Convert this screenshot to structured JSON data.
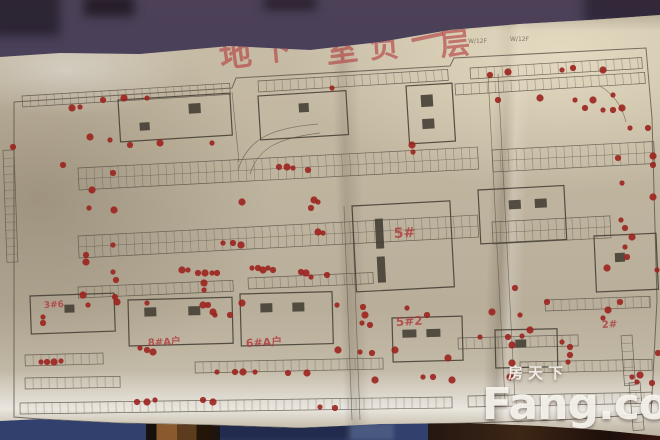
{
  "watermark": {
    "line1": "房天下",
    "line2": "Fang.com"
  },
  "title": {
    "text": "地下室负一层",
    "color": "#b23a3c",
    "chars": [
      {
        "c": "地",
        "x": 237,
        "y": 66,
        "s": 32,
        "r": -8
      },
      {
        "c": "下",
        "x": 277,
        "y": 60,
        "s": 30,
        "r": -5
      },
      {
        "c": "室",
        "x": 343,
        "y": 61,
        "s": 32,
        "r": -7
      },
      {
        "c": "负",
        "x": 385,
        "y": 57,
        "s": 30,
        "r": -4
      },
      {
        "c": "一",
        "x": 430,
        "y": 50,
        "s": 34,
        "r": -12
      },
      {
        "c": "层",
        "x": 456,
        "y": 54,
        "s": 30,
        "r": -6
      }
    ]
  },
  "plan": {
    "colors": {
      "paper": "#c3b8a2",
      "wall_top": "#4c4157",
      "wall_bottom": "#31406d",
      "line": "#5b5448",
      "building": "#474136",
      "core": "#3e382f",
      "dot": "#9c221e",
      "marker": "#b23a3c",
      "pencil": "#7a7263"
    },
    "boundary": "M14,102 L232,88 L236,78 L450,66 L454,58 L646,48 L652,118 L657,300 L651,414 L560,420 L470,423 L380,425 L300,428 L210,425 L118,423 L40,419 L14,417 Z",
    "roads": [
      "M238,170 C248,138 272,128 318,124",
      "M250,174 C258,148 278,138 320,133",
      "M488,74 L505,400",
      "M498,74 L515,400",
      "M344,206 L352,420",
      "M352,206 L360,420",
      "M232,92 L239,162",
      "M600,86 Q620,98 626,122"
    ],
    "strips": [
      {
        "x": 22,
        "y": 96,
        "w": 208,
        "rows": 1,
        "t": -3.5
      },
      {
        "x": 258,
        "y": 81,
        "w": 190,
        "rows": 1,
        "t": -3.5
      },
      {
        "x": 470,
        "y": 68,
        "w": 172,
        "rows": 1,
        "t": -3.5
      },
      {
        "x": 455,
        "y": 84,
        "w": 190,
        "rows": 1,
        "t": -3.5
      },
      {
        "x": 78,
        "y": 168,
        "w": 400,
        "rows": 2,
        "t": -3
      },
      {
        "x": 492,
        "y": 150,
        "w": 162,
        "rows": 2,
        "t": -3
      },
      {
        "x": 78,
        "y": 236,
        "w": 400,
        "rows": 2,
        "t": -3
      },
      {
        "x": 492,
        "y": 222,
        "w": 118,
        "rows": 2,
        "t": -3
      },
      {
        "x": 78,
        "y": 287,
        "w": 155,
        "rows": 1,
        "t": -2.5
      },
      {
        "x": 248,
        "y": 278,
        "w": 125,
        "rows": 1,
        "t": -2.5
      },
      {
        "x": 545,
        "y": 300,
        "w": 105,
        "rows": 1,
        "t": -2
      },
      {
        "x": 25,
        "y": 355,
        "w": 78,
        "rows": 1,
        "t": -1.5
      },
      {
        "x": 25,
        "y": 378,
        "w": 95,
        "rows": 1,
        "t": -1
      },
      {
        "x": 195,
        "y": 362,
        "w": 188,
        "rows": 1,
        "t": -1.2
      },
      {
        "x": 458,
        "y": 338,
        "w": 120,
        "rows": 1,
        "t": -1.5
      },
      {
        "x": 520,
        "y": 362,
        "w": 132,
        "rows": 1,
        "t": -1.2
      },
      {
        "x": 20,
        "y": 403,
        "w": 432,
        "rows": 1,
        "t": -0.8
      },
      {
        "x": 468,
        "y": 396,
        "w": 184,
        "rows": 1,
        "t": -1.2
      },
      {
        "x": 14,
        "y": 150,
        "w": 112,
        "rows": 1,
        "t": 88
      },
      {
        "x": 632,
        "y": 335,
        "w": 50,
        "rows": 1,
        "t": 86
      },
      {
        "x": 640,
        "y": 382,
        "w": 48,
        "rows": 1,
        "t": 85
      }
    ],
    "buildings": [
      {
        "x": 118,
        "y": 100,
        "w": 112,
        "h": 42,
        "t": -3.5,
        "cores": [
          [
            70,
            8,
            12,
            10
          ],
          [
            20,
            24,
            10,
            8
          ]
        ]
      },
      {
        "x": 258,
        "y": 96,
        "w": 88,
        "h": 44,
        "t": -3.5,
        "cores": [
          [
            40,
            10,
            10,
            9
          ]
        ]
      },
      {
        "x": 406,
        "y": 86,
        "w": 46,
        "h": 58,
        "t": -3.5,
        "cores": [
          [
            14,
            10,
            12,
            12
          ],
          [
            14,
            34,
            12,
            10
          ]
        ]
      },
      {
        "x": 352,
        "y": 206,
        "w": 98,
        "h": 86,
        "t": -3,
        "cores": [
          [
            22,
            14,
            8,
            30
          ],
          [
            22,
            52,
            8,
            26
          ]
        ]
      },
      {
        "x": 478,
        "y": 190,
        "w": 86,
        "h": 54,
        "t": -3,
        "cores": [
          [
            30,
            12,
            12,
            9
          ],
          [
            56,
            12,
            12,
            9
          ]
        ]
      },
      {
        "x": 594,
        "y": 236,
        "w": 62,
        "h": 56,
        "t": -2.5,
        "cores": [
          [
            20,
            18,
            10,
            9
          ]
        ]
      },
      {
        "x": 30,
        "y": 296,
        "w": 84,
        "h": 38,
        "t": -2,
        "cores": [
          [
            34,
            10,
            10,
            8
          ]
        ]
      },
      {
        "x": 128,
        "y": 300,
        "w": 104,
        "h": 46,
        "t": -1.5,
        "cores": [
          [
            16,
            8,
            12,
            9
          ],
          [
            60,
            8,
            12,
            9
          ]
        ]
      },
      {
        "x": 240,
        "y": 294,
        "w": 92,
        "h": 52,
        "t": -1.5,
        "cores": [
          [
            20,
            10,
            12,
            9
          ],
          [
            52,
            10,
            12,
            9
          ]
        ]
      },
      {
        "x": 392,
        "y": 318,
        "w": 70,
        "h": 44,
        "t": -1.5,
        "cores": [
          [
            10,
            12,
            14,
            8
          ],
          [
            34,
            12,
            14,
            8
          ]
        ]
      },
      {
        "x": 495,
        "y": 330,
        "w": 62,
        "h": 38,
        "t": -1.2,
        "cores": [
          [
            20,
            10,
            11,
            8
          ]
        ]
      }
    ],
    "annotations": [
      {
        "text": "5#",
        "x": 394,
        "y": 238,
        "size": 14
      },
      {
        "text": "5#2",
        "x": 396,
        "y": 326,
        "size": 12
      },
      {
        "text": "6#A户",
        "x": 246,
        "y": 347,
        "size": 11
      },
      {
        "text": "8#A户",
        "x": 148,
        "y": 346,
        "size": 10
      },
      {
        "text": "3#6",
        "x": 44,
        "y": 308,
        "size": 9
      },
      {
        "text": "2#",
        "x": 602,
        "y": 328,
        "size": 10
      }
    ],
    "pencil_notes": [
      {
        "text": "W/12F",
        "x": 468,
        "y": 43
      },
      {
        "text": "W/12F",
        "x": 510,
        "y": 41
      }
    ],
    "dots": [
      [
        332,
        88
      ],
      [
        490,
        75
      ],
      [
        508,
        72
      ],
      [
        562,
        70
      ],
      [
        573,
        68
      ],
      [
        603,
        70
      ],
      [
        613,
        95
      ],
      [
        498,
        100
      ],
      [
        540,
        98
      ],
      [
        575,
        100
      ],
      [
        585,
        108
      ],
      [
        593,
        100
      ],
      [
        603,
        110
      ],
      [
        613,
        110
      ],
      [
        622,
        108
      ],
      [
        630,
        128
      ],
      [
        648,
        128
      ],
      [
        72,
        108
      ],
      [
        80,
        107
      ],
      [
        103,
        100
      ],
      [
        124,
        98
      ],
      [
        147,
        98
      ],
      [
        13,
        147
      ],
      [
        90,
        137
      ],
      [
        110,
        140
      ],
      [
        130,
        145
      ],
      [
        160,
        143
      ],
      [
        212,
        143
      ],
      [
        63,
        165
      ],
      [
        92,
        190
      ],
      [
        89,
        208
      ],
      [
        113,
        173
      ],
      [
        114,
        210
      ],
      [
        113,
        245
      ],
      [
        86,
        255
      ],
      [
        86,
        262
      ],
      [
        113,
        272
      ],
      [
        116,
        280
      ],
      [
        242,
        202
      ],
      [
        223,
        243
      ],
      [
        233,
        243
      ],
      [
        241,
        245
      ],
      [
        252,
        268
      ],
      [
        258,
        268
      ],
      [
        263,
        270
      ],
      [
        268,
        268
      ],
      [
        273,
        270
      ],
      [
        182,
        270
      ],
      [
        188,
        270
      ],
      [
        198,
        273
      ],
      [
        205,
        273
      ],
      [
        212,
        273
      ],
      [
        217,
        273
      ],
      [
        204,
        283
      ],
      [
        204,
        290
      ],
      [
        279,
        167
      ],
      [
        287,
        167
      ],
      [
        293,
        168
      ],
      [
        308,
        170
      ],
      [
        314,
        200
      ],
      [
        318,
        202
      ],
      [
        311,
        208
      ],
      [
        318,
        232
      ],
      [
        323,
        233
      ],
      [
        301,
        272
      ],
      [
        306,
        273
      ],
      [
        311,
        277
      ],
      [
        327,
        275
      ],
      [
        412,
        145
      ],
      [
        413,
        152
      ],
      [
        618,
        158
      ],
      [
        653,
        156
      ],
      [
        622,
        183
      ],
      [
        653,
        165
      ],
      [
        653,
        197
      ],
      [
        621,
        220
      ],
      [
        625,
        228
      ],
      [
        632,
        237
      ],
      [
        625,
        247
      ],
      [
        627,
        257
      ],
      [
        607,
        268
      ],
      [
        657,
        270
      ],
      [
        620,
        302
      ],
      [
        608,
        310
      ],
      [
        603,
        318
      ],
      [
        658,
        353
      ],
      [
        640,
        375
      ],
      [
        632,
        377
      ],
      [
        652,
        383
      ],
      [
        203,
        305
      ],
      [
        215,
        315
      ],
      [
        230,
        315
      ],
      [
        242,
        303
      ],
      [
        337,
        305
      ],
      [
        363,
        307
      ],
      [
        365,
        315
      ],
      [
        362,
        323
      ],
      [
        370,
        325
      ],
      [
        338,
        350
      ],
      [
        360,
        352
      ],
      [
        372,
        353
      ],
      [
        395,
        350
      ],
      [
        407,
        308
      ],
      [
        427,
        315
      ],
      [
        448,
        358
      ],
      [
        217,
        372
      ],
      [
        235,
        372
      ],
      [
        243,
        372
      ],
      [
        255,
        372
      ],
      [
        288,
        373
      ],
      [
        307,
        373
      ],
      [
        320,
        407
      ],
      [
        335,
        408
      ],
      [
        375,
        380
      ],
      [
        423,
        377
      ],
      [
        433,
        377
      ],
      [
        452,
        380
      ],
      [
        43,
        317
      ],
      [
        43,
        323
      ],
      [
        83,
        295
      ],
      [
        88,
        305
      ],
      [
        115,
        297
      ],
      [
        117,
        302
      ],
      [
        147,
        303
      ],
      [
        208,
        305
      ],
      [
        213,
        312
      ],
      [
        140,
        348
      ],
      [
        147,
        350
      ],
      [
        153,
        352
      ],
      [
        41,
        362
      ],
      [
        47,
        362
      ],
      [
        54,
        362
      ],
      [
        61,
        361
      ],
      [
        137,
        402
      ],
      [
        147,
        402
      ],
      [
        155,
        400
      ],
      [
        203,
        400
      ],
      [
        213,
        402
      ],
      [
        480,
        337
      ],
      [
        508,
        337
      ],
      [
        512,
        345
      ],
      [
        562,
        342
      ],
      [
        570,
        347
      ],
      [
        512,
        363
      ],
      [
        568,
        362
      ],
      [
        570,
        355
      ],
      [
        510,
        377
      ],
      [
        522,
        336
      ],
      [
        515,
        288
      ],
      [
        492,
        312
      ],
      [
        520,
        315
      ],
      [
        547,
        302
      ],
      [
        530,
        330
      ],
      [
        637,
        382
      ]
    ]
  }
}
